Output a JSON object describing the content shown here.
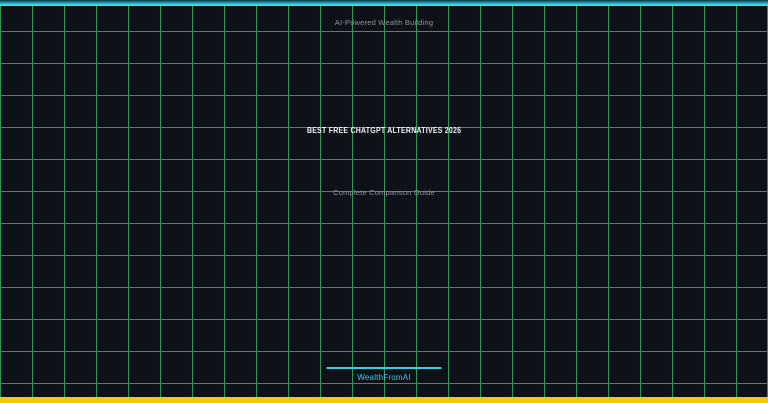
{
  "hero": {
    "tagline": "AI-Powered Wealth Building",
    "title": "BEST FREE CHATGPT ALTERNATIVES 2026",
    "subtitle": "Complete Comparison Guide",
    "brand": "WealthFromAI"
  },
  "colors": {
    "background": "#0e1118",
    "grid_line": "#19a05a",
    "top_bar_cyan": "#35dced",
    "bottom_bar_yellow": "#f4c90c",
    "accent_cyan": "#38cede",
    "muted_text": "#8e959e",
    "title_text": "#f2f3f5"
  }
}
